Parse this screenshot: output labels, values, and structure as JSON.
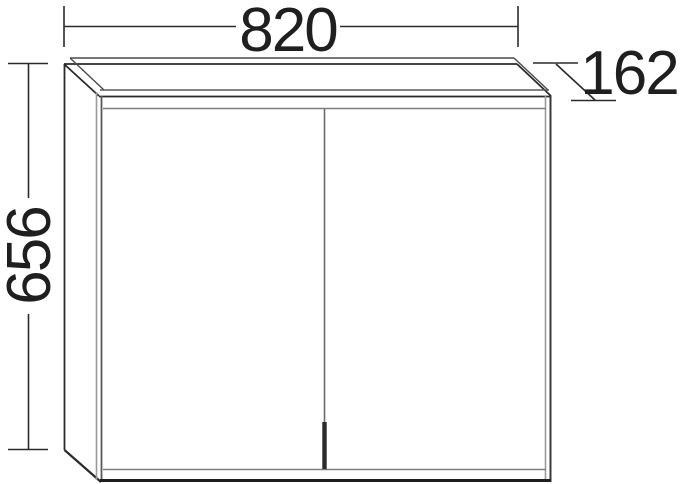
{
  "drawing": {
    "type": "technical-dimension-drawing",
    "subject": "two-door wall cabinet shown in perspective from front-left-above",
    "dimensions": {
      "width": "820",
      "height": "656",
      "depth": "162"
    },
    "colors": {
      "background": "#ffffff",
      "line_dark": "#2a2a2a",
      "line_medium": "#5a5a5a",
      "line_gray": "#949494"
    }
  }
}
